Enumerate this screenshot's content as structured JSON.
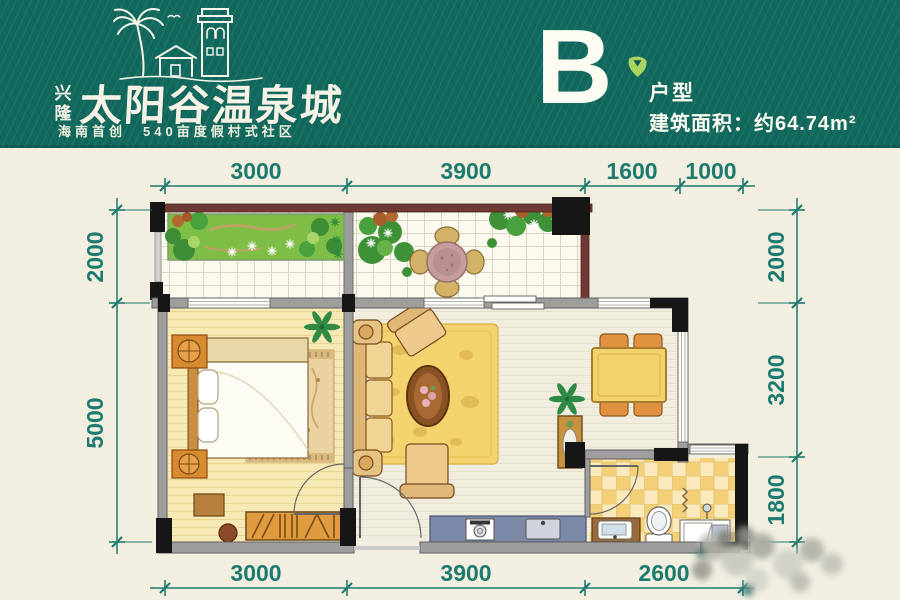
{
  "header": {
    "brand_small": "兴隆",
    "brand_name": "太阳谷温泉城",
    "tagline": "海南首创　540亩度假村式社区",
    "unit": {
      "letter": "B",
      "type_label": "户型",
      "area_label": "建筑面积：约64.74m²"
    },
    "colors": {
      "banner_teal": "#11695e",
      "text_white": "#f6f3e6",
      "leaf_green": "#a8d45f"
    }
  },
  "plan": {
    "dims_top": [
      "3000",
      "3900",
      "1600",
      "1000"
    ],
    "dims_bottom": [
      "3000",
      "3900",
      "2600"
    ],
    "dims_left": [
      "2000",
      "5000"
    ],
    "dims_right": [
      "2000",
      "3200",
      "1800"
    ],
    "colors": {
      "background_cream": "#f2efe1",
      "dimension_teal": "#1d7a6e",
      "wall_maroon": "#6e3a33",
      "wall_gray": "#9e9e9e",
      "pillar_black": "#161616",
      "bedroom_floor": "#f7e9b4",
      "bath_tile": "#f3d077",
      "kitchen_counter": "#7b88a6",
      "rug_yellow": "#f2d36e",
      "garden_green": "#7fbe46"
    }
  }
}
